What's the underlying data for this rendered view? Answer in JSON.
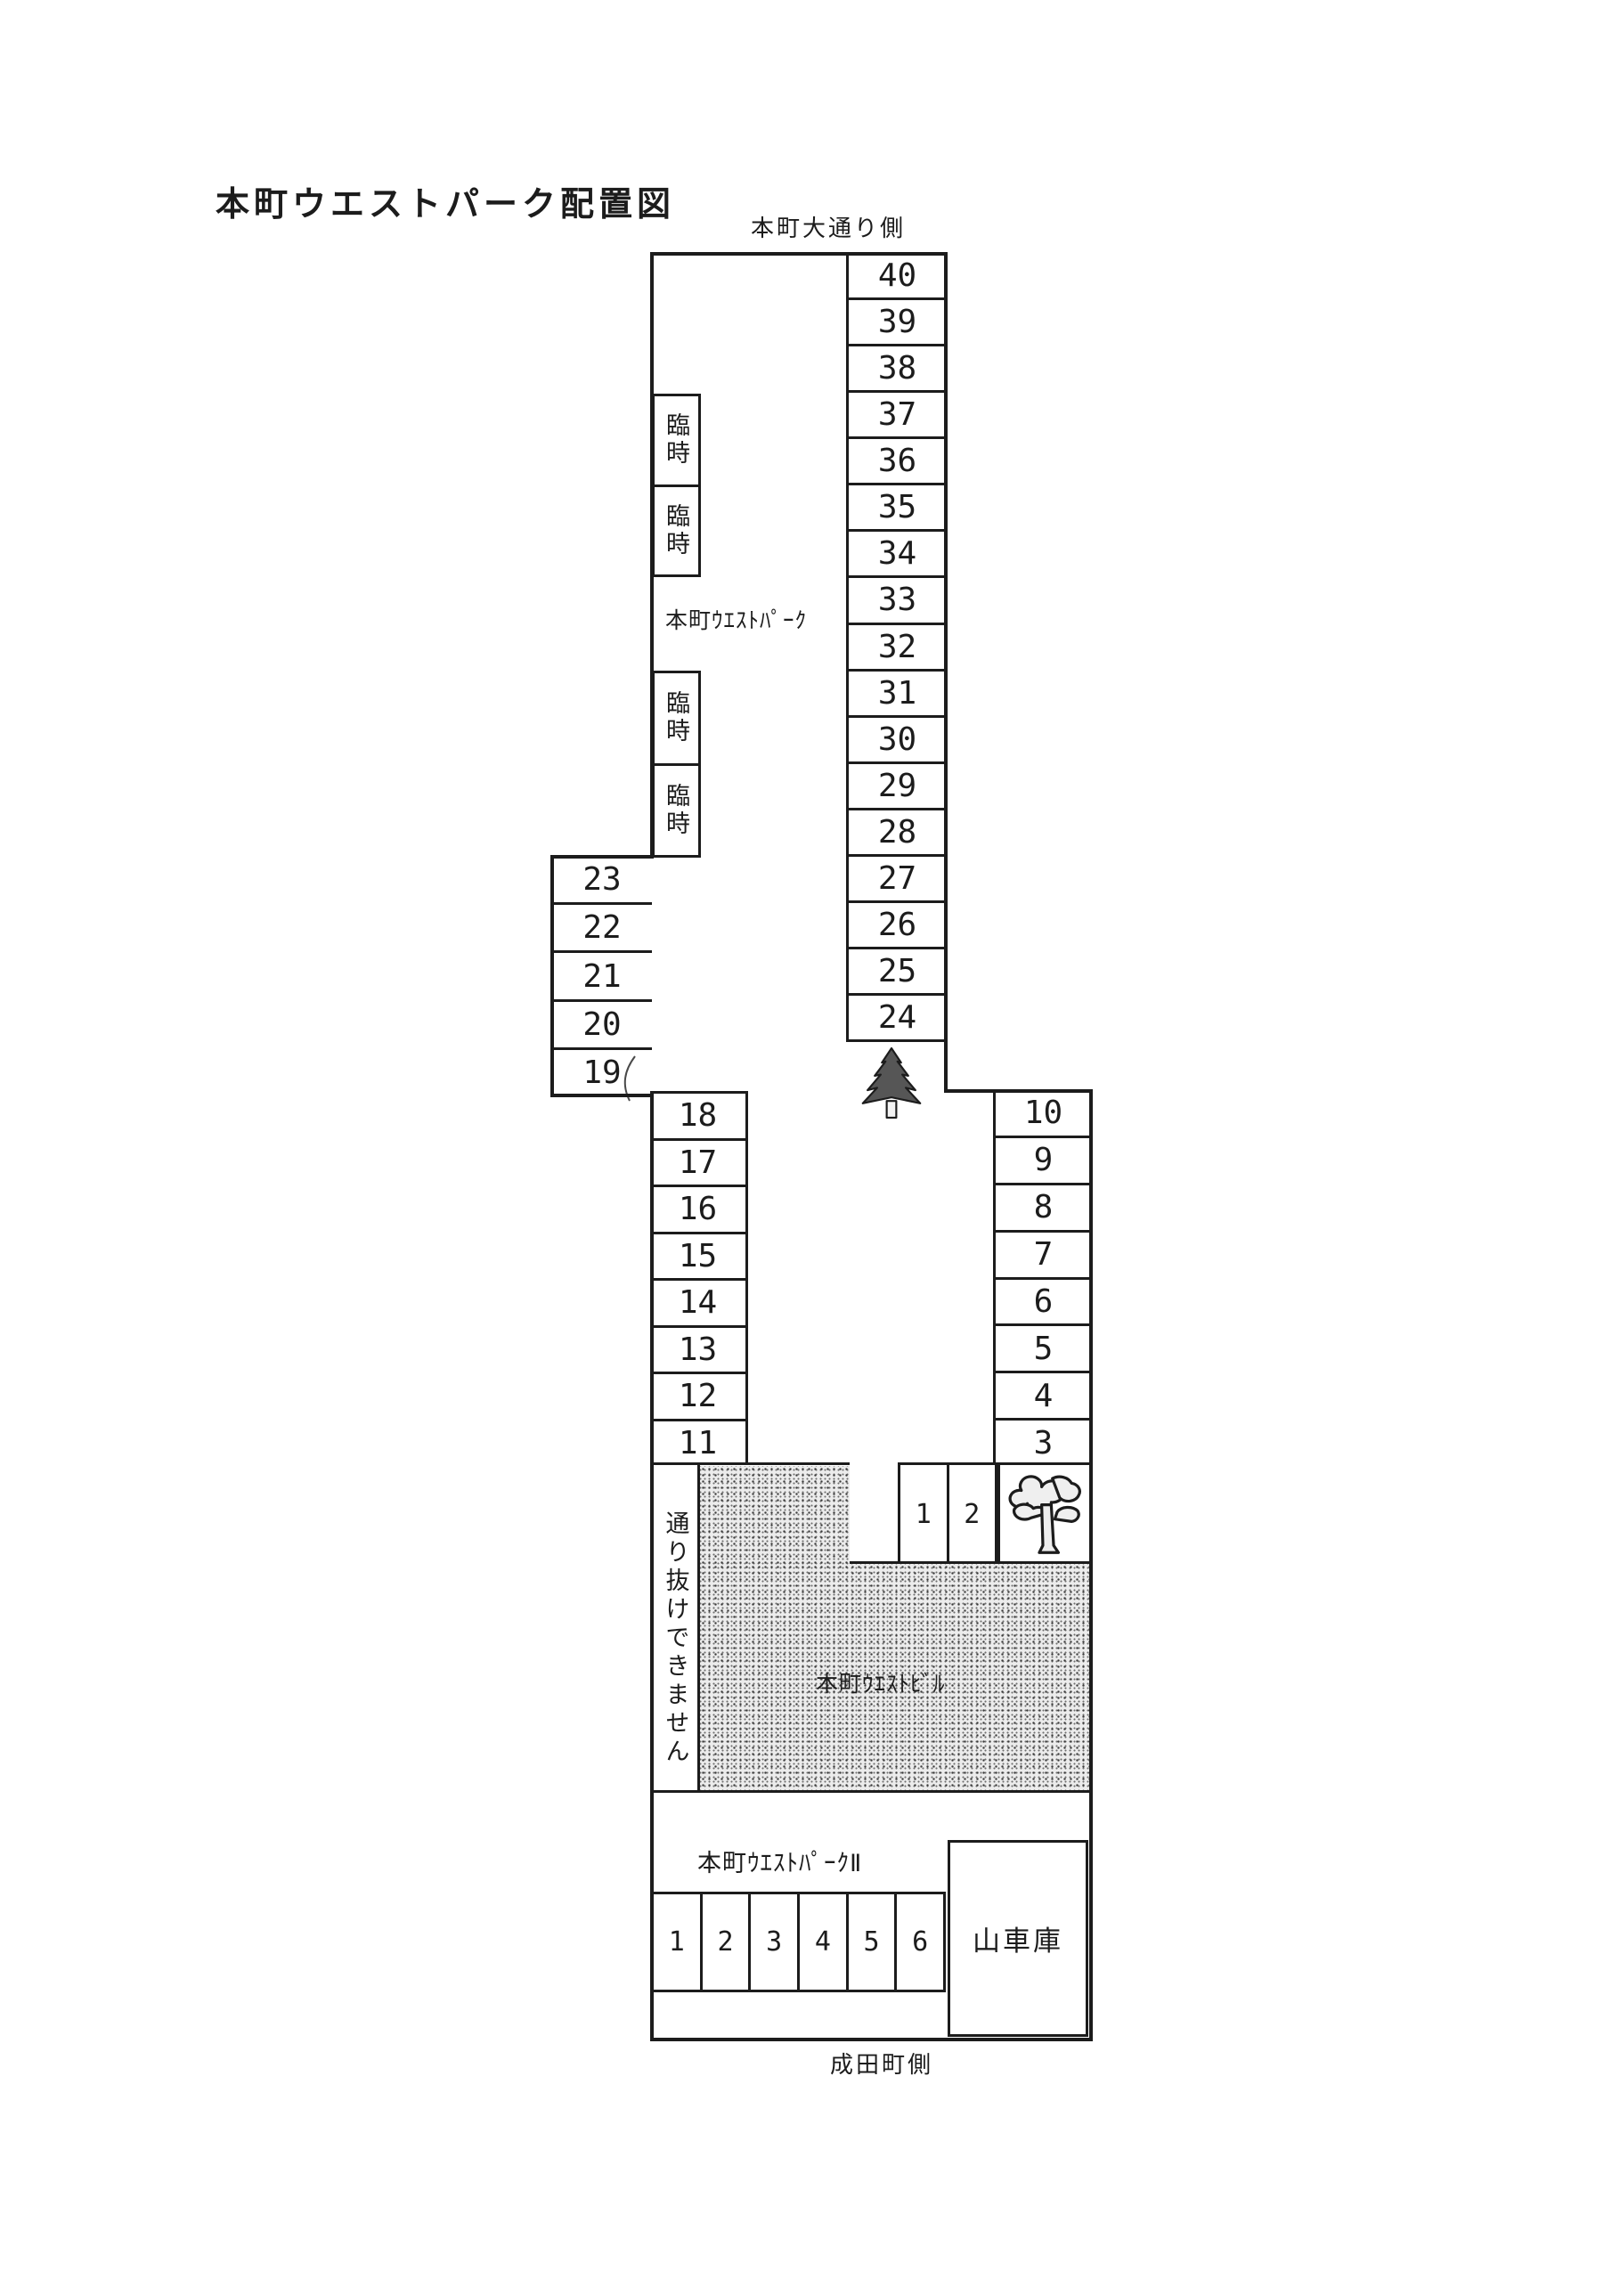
{
  "page": {
    "title": "本町ウエストパーク配置図",
    "top_edge_label": "本町大通り側",
    "bottom_edge_label": "成田町側"
  },
  "stem": {
    "area_label": "本町ｳｴｽﾄﾊﾟｰｸ",
    "main_column_spaces": [
      "40",
      "39",
      "38",
      "37",
      "36",
      "35",
      "34",
      "33",
      "32",
      "31",
      "30",
      "29",
      "28",
      "27",
      "26",
      "25",
      "24"
    ],
    "west_column_spaces": [
      "23",
      "22",
      "21",
      "20",
      "19"
    ],
    "temporary_spaces_upper": [
      "臨時",
      "臨時"
    ],
    "temporary_spaces_lower": [
      "臨時",
      "臨時"
    ]
  },
  "middle": {
    "west_column_spaces": [
      "18",
      "17",
      "16",
      "15",
      "14",
      "13",
      "12",
      "11"
    ],
    "east_column_spaces": [
      "10",
      "9",
      "8",
      "7",
      "6",
      "5",
      "4",
      "3"
    ],
    "small_spaces": [
      "1",
      "2"
    ]
  },
  "building": {
    "label": "本町ｳｴｽﾄﾋﾞﾙ",
    "no_through_notice": "通り抜けできません"
  },
  "park2": {
    "area_label": "本町ｳｴｽﾄﾊﾟｰｸⅡ",
    "spaces": [
      "1",
      "2",
      "3",
      "4",
      "5",
      "6"
    ],
    "garage_label": "山車庫"
  },
  "icons": {
    "pine_tree": "pine-tree-icon",
    "broadleaf_tree": "broadleaf-tree-icon"
  },
  "colors": {
    "ink": "#1c1c1c",
    "paper": "#ffffff",
    "building_fill": "#ececec",
    "building_dot": "#3a3a3a"
  }
}
